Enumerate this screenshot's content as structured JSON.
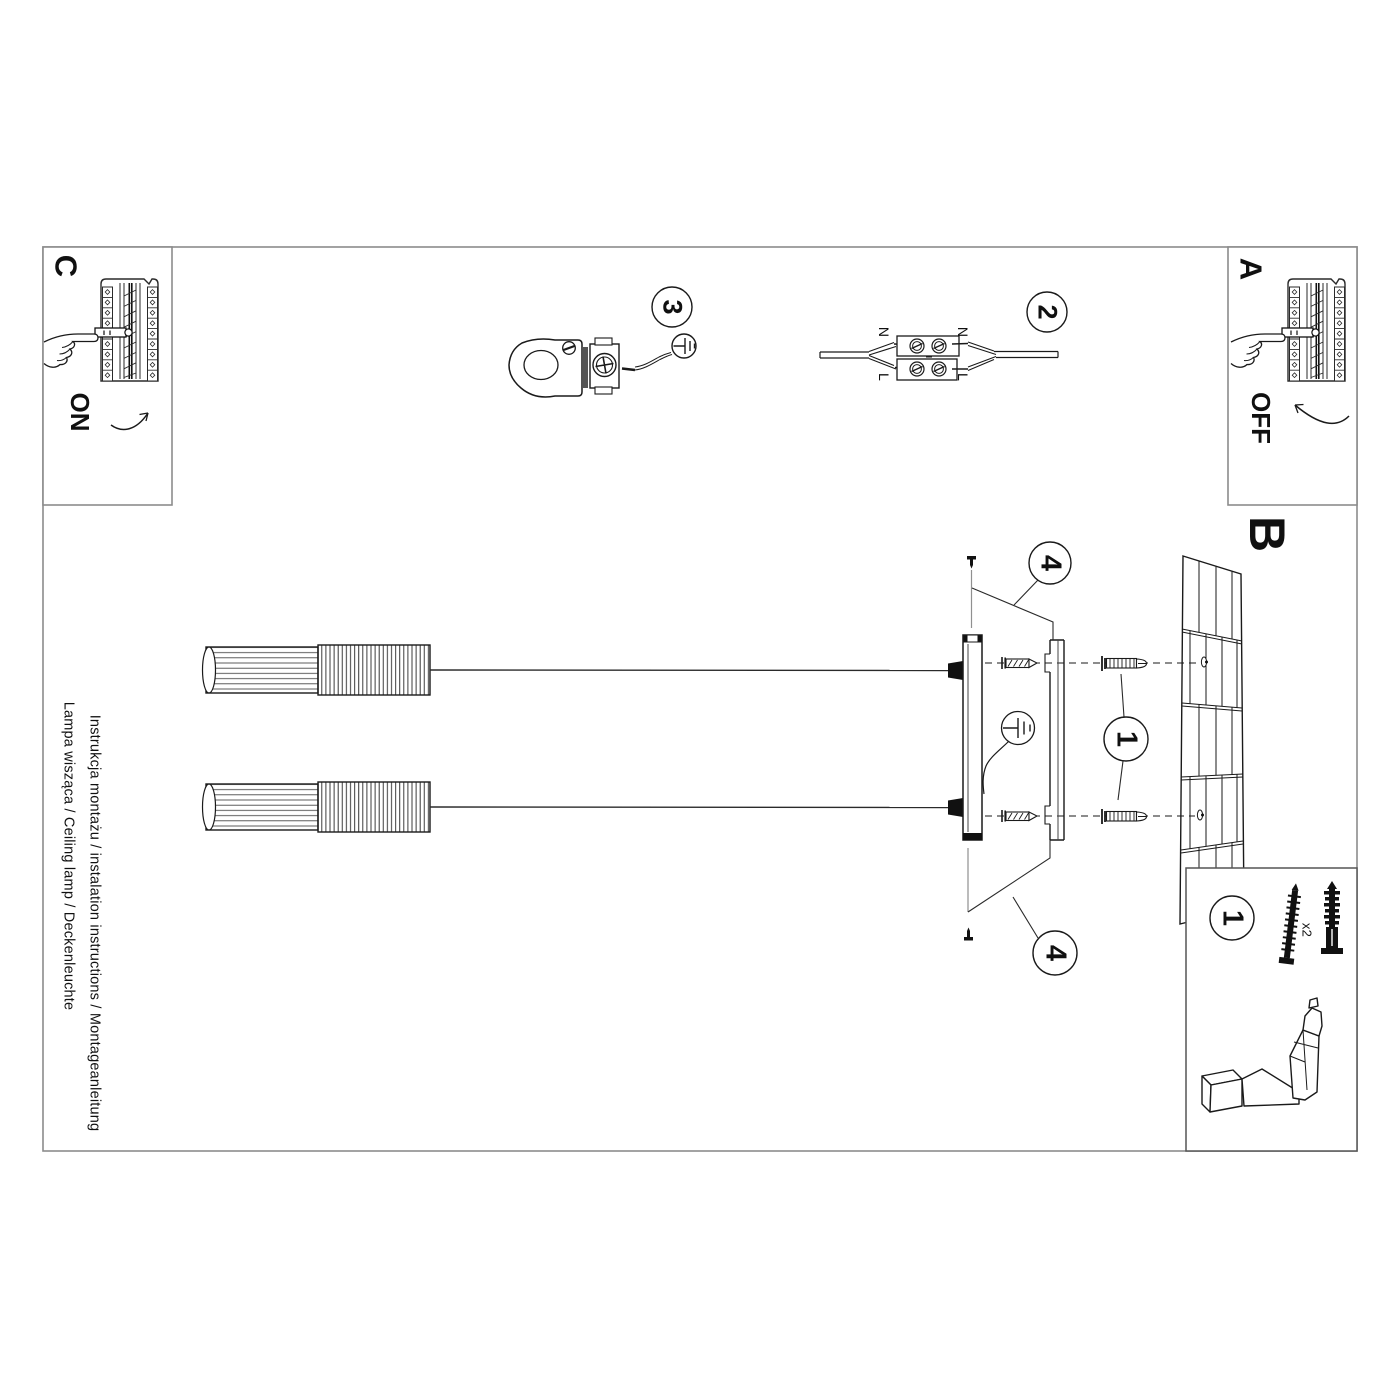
{
  "sheet": {
    "margin_line1": "Instrukcja montażu / instalation instructions / Montageanleitung",
    "margin_line2": "Lampa wisząca / Ceiling lamp / Deckenleuchte"
  },
  "sections": {
    "a": "A",
    "b": "B",
    "c": "C"
  },
  "power": {
    "on": "ON",
    "off": "OFF"
  },
  "step_badges": {
    "one": "1",
    "two": "2",
    "three": "3",
    "four": "4"
  },
  "wiring": {
    "neutral": "N",
    "live": "L"
  },
  "hardware": {
    "screw_qty": "x2"
  },
  "colors": {
    "line": "#1a1a1a",
    "frame": "#8c8c8c",
    "paper": "#ffffff"
  }
}
